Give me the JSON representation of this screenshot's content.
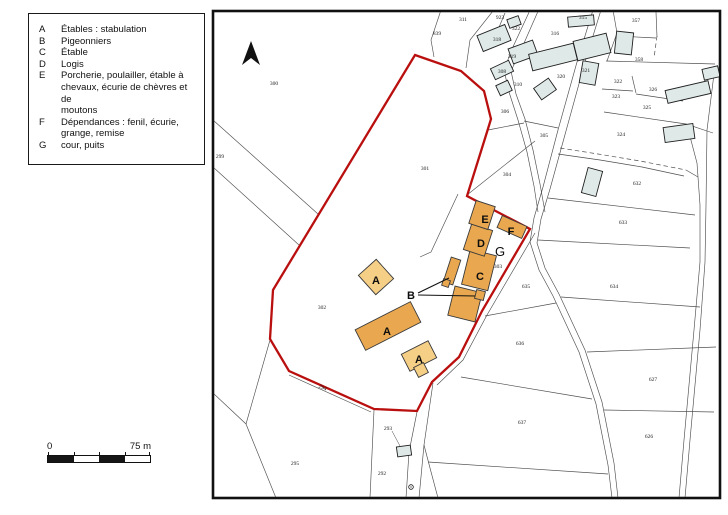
{
  "legend": {
    "items": [
      {
        "key": "A",
        "label": "Étables : stabulation"
      },
      {
        "key": "B",
        "label": "Pigeonniers"
      },
      {
        "key": "C",
        "label": "Étable"
      },
      {
        "key": "D",
        "label": "Logis"
      },
      {
        "key": "E",
        "label": "Porcherie, poulailler, étable à\nchevaux, écurie de chèvres et de\nmoutons"
      },
      {
        "key": "F",
        "label": "Dépendances : fenil, écurie,\ngrange, remise"
      },
      {
        "key": "G",
        "label": "cour, puits"
      }
    ]
  },
  "scale_bar": {
    "start_label": "0",
    "end_label": "75 m"
  },
  "map": {
    "colors": {
      "red_boundary": "#b90f0e",
      "farm_dark": "#e9a850",
      "farm_light": "#f6cf86",
      "village_fill": "#dfe9e8"
    },
    "building_letters": [
      {
        "t": "A",
        "x": 376,
        "y": 284,
        "s": 11
      },
      {
        "t": "A",
        "x": 387,
        "y": 335,
        "s": 11
      },
      {
        "t": "A",
        "x": 419,
        "y": 363,
        "s": 11
      },
      {
        "t": "B",
        "x": 411,
        "y": 299,
        "s": 11
      },
      {
        "t": "C",
        "x": 480,
        "y": 280,
        "s": 11
      },
      {
        "t": "D",
        "x": 481,
        "y": 247,
        "s": 11
      },
      {
        "t": "E",
        "x": 485,
        "y": 223,
        "s": 11
      },
      {
        "t": "F",
        "x": 511,
        "y": 235,
        "s": 11
      },
      {
        "t": "G",
        "x": 500,
        "y": 256,
        "s": 13,
        "g": true
      }
    ],
    "parcel_numbers": [
      {
        "t": "311",
        "x": 463,
        "y": 21
      },
      {
        "t": "839",
        "x": 437,
        "y": 35
      },
      {
        "t": "923",
        "x": 500,
        "y": 19
      },
      {
        "t": "322",
        "x": 516,
        "y": 30
      },
      {
        "t": "318",
        "x": 497,
        "y": 41
      },
      {
        "t": "316",
        "x": 555,
        "y": 35
      },
      {
        "t": "319",
        "x": 512,
        "y": 58
      },
      {
        "t": "308",
        "x": 502,
        "y": 73
      },
      {
        "t": "310",
        "x": 518,
        "y": 86
      },
      {
        "t": "306",
        "x": 505,
        "y": 113
      },
      {
        "t": "315",
        "x": 583,
        "y": 19
      },
      {
        "t": "357",
        "x": 636,
        "y": 22
      },
      {
        "t": "358",
        "x": 639,
        "y": 61
      },
      {
        "t": "321",
        "x": 586,
        "y": 72
      },
      {
        "t": "320",
        "x": 561,
        "y": 78
      },
      {
        "t": "322",
        "x": 618,
        "y": 83
      },
      {
        "t": "326",
        "x": 653,
        "y": 91
      },
      {
        "t": "323",
        "x": 616,
        "y": 98
      },
      {
        "t": "325",
        "x": 647,
        "y": 109
      },
      {
        "t": "324",
        "x": 621,
        "y": 136
      },
      {
        "t": "632",
        "x": 637,
        "y": 185
      },
      {
        "t": "633",
        "x": 623,
        "y": 224
      },
      {
        "t": "634",
        "x": 614,
        "y": 288
      },
      {
        "t": "300",
        "x": 274,
        "y": 85
      },
      {
        "t": "299",
        "x": 220,
        "y": 158
      },
      {
        "t": "301",
        "x": 425,
        "y": 170
      },
      {
        "t": "305",
        "x": 544,
        "y": 137
      },
      {
        "t": "304",
        "x": 507,
        "y": 176
      },
      {
        "t": "302",
        "x": 322,
        "y": 309
      },
      {
        "t": "303",
        "x": 498,
        "y": 268
      },
      {
        "t": "635",
        "x": 526,
        "y": 288
      },
      {
        "t": "636",
        "x": 520,
        "y": 345
      },
      {
        "t": "637",
        "x": 522,
        "y": 424
      },
      {
        "t": "627",
        "x": 653,
        "y": 381
      },
      {
        "t": "626",
        "x": 649,
        "y": 438
      },
      {
        "t": "294",
        "x": 322,
        "y": 389,
        "r": 24
      },
      {
        "t": "295",
        "x": 295,
        "y": 465
      },
      {
        "t": "293",
        "x": 388,
        "y": 430
      },
      {
        "t": "292",
        "x": 382,
        "y": 475
      }
    ]
  }
}
